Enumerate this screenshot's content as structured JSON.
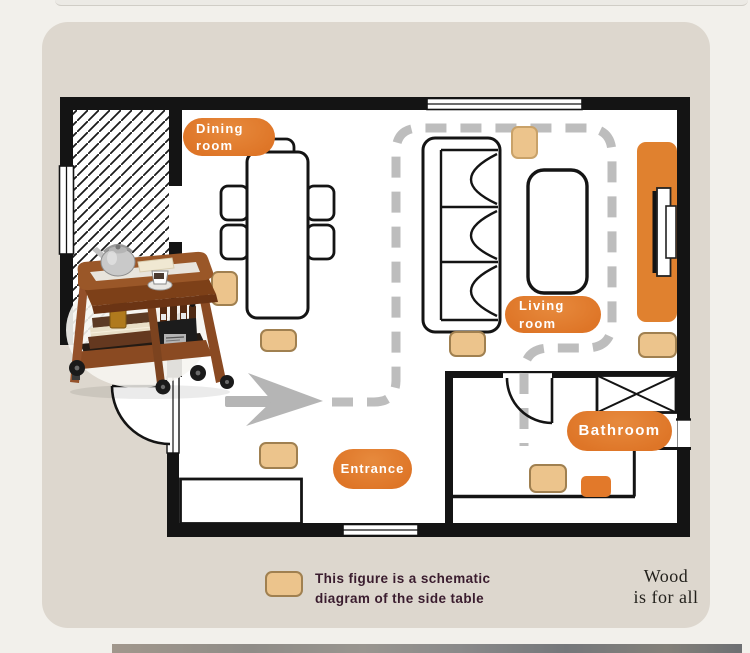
{
  "floorplan": {
    "badges": {
      "dining": {
        "line1": "Dining",
        "line2": "room"
      },
      "living": {
        "line1": "Living",
        "line2": "room"
      },
      "bathroom": {
        "label": "Bathroom"
      },
      "entrance": {
        "label": "Entrance"
      }
    },
    "symbols": {
      "tan_marker_meaning": "side table position",
      "dashed_line_meaning": "walking path",
      "arrow_meaning": "entry direction"
    }
  },
  "legend": {
    "line1": "This figure is a schematic",
    "line2": "diagram of the side table"
  },
  "brand": {
    "line1": "Wood",
    "line2": "is for all"
  },
  "colors": {
    "accent_orange": "#e07b2e",
    "marker_tan": "#ecc48c",
    "marker_tan_border": "#a08050",
    "marker_orange": "#e2792a",
    "wall_black": "#141414",
    "path_gray": "#bdbdbd",
    "card_bg": "#ddd7ce",
    "page_bg": "#f2f0eb",
    "legend_text": "#3a1c2e",
    "wood_brown": "#9a5728"
  }
}
